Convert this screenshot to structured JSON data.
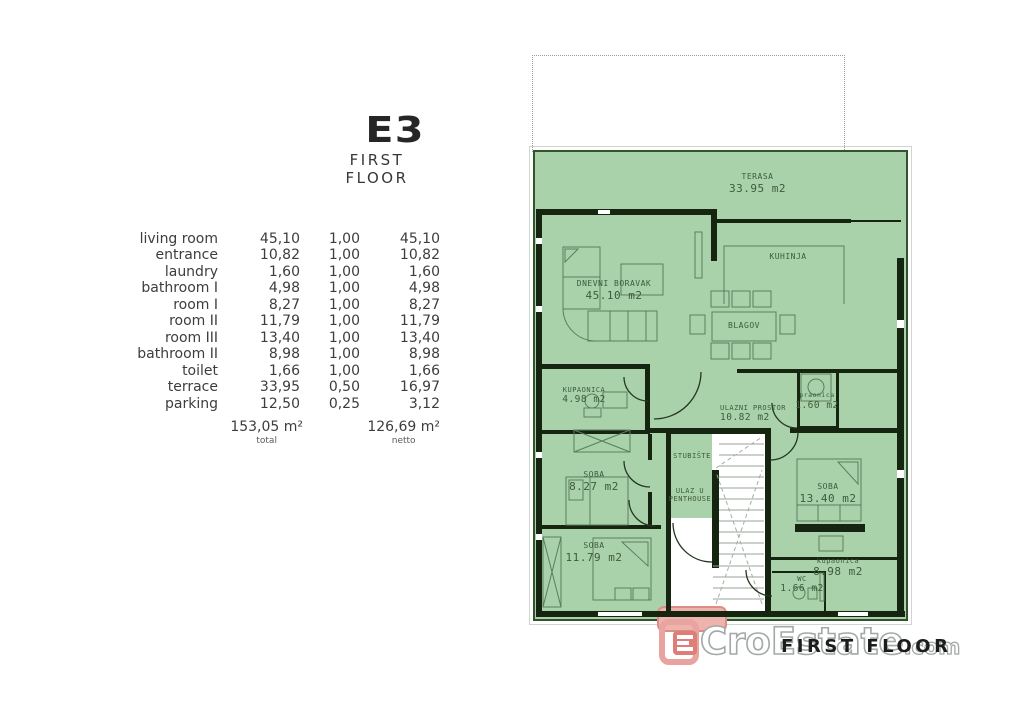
{
  "title": {
    "code": "E3",
    "floor": "FIRST FLOOR"
  },
  "area_table": {
    "rows": [
      {
        "name": "living room",
        "area": "45,10",
        "coef": "1,00",
        "net": "45,10"
      },
      {
        "name": "entrance",
        "area": "10,82",
        "coef": "1,00",
        "net": "10,82"
      },
      {
        "name": "laundry",
        "area": "1,60",
        "coef": "1,00",
        "net": "1,60"
      },
      {
        "name": "bathroom I",
        "area": "4,98",
        "coef": "1,00",
        "net": "4,98"
      },
      {
        "name": "room I",
        "area": "8,27",
        "coef": "1,00",
        "net": "8,27"
      },
      {
        "name": "room II",
        "area": "11,79",
        "coef": "1,00",
        "net": "11,79"
      },
      {
        "name": "room III",
        "area": "13,40",
        "coef": "1,00",
        "net": "13,40"
      },
      {
        "name": "bathroom II",
        "area": "8,98",
        "coef": "1,00",
        "net": "8,98"
      },
      {
        "name": "toilet",
        "area": "1,66",
        "coef": "1,00",
        "net": "1,66"
      },
      {
        "name": "terrace",
        "area": "33,95",
        "coef": "0,50",
        "net": "16,97"
      },
      {
        "name": "parking",
        "area": "12,50",
        "coef": "0,25",
        "net": "3,12"
      }
    ],
    "totals": {
      "total_value": "153,05 m²",
      "total_label": "total",
      "net_value": "126,69 m²",
      "net_label": "netto"
    }
  },
  "plan": {
    "labels": {
      "terasa": {
        "name": "TERASA",
        "area": "33.95 m2"
      },
      "dnevni_boravak": {
        "name": "DNEVNI BORAVAK",
        "area": "45.10 m2"
      },
      "kuhinja": {
        "name": "KUHINJA"
      },
      "blagov": {
        "name": "BLAGOV"
      },
      "kupaonica_gornja": {
        "name": "KUPAONICA",
        "area": "4.98 m2"
      },
      "ulazni_prostor": {
        "name": "ULAZNI PROSTOR",
        "area": "10.82 m2"
      },
      "praonica": {
        "name": "praonica",
        "area": "1.60 m2"
      },
      "soba_1": {
        "name": "SOBA",
        "area": "8.27 m2"
      },
      "stubiste": {
        "name": "STUBIŠTE"
      },
      "ulaz_u_penthouse": {
        "line1": "ULAZ U",
        "line2": "PENTHOUSE"
      },
      "soba_2": {
        "name": "SOBA",
        "area": "11.79 m2"
      },
      "soba_3": {
        "name": "SOBA",
        "area": "13.40 m2"
      },
      "kupaonica_donja": {
        "name": "kupaonica",
        "area": "8.98 m2"
      },
      "wc": {
        "name": "WC",
        "area": "1.66 m2"
      }
    },
    "colors": {
      "room_fill": "#a9d2ab",
      "wall": "#15250f",
      "furniture_line": "#5b7d5e",
      "label_text": "#3e5a3b",
      "entry_mat": "#efb3ae"
    }
  },
  "logo": {
    "watermark_text": "CroEstate",
    "watermark_suffix": ".com",
    "overlay_text": "FIRST FLOOR"
  }
}
